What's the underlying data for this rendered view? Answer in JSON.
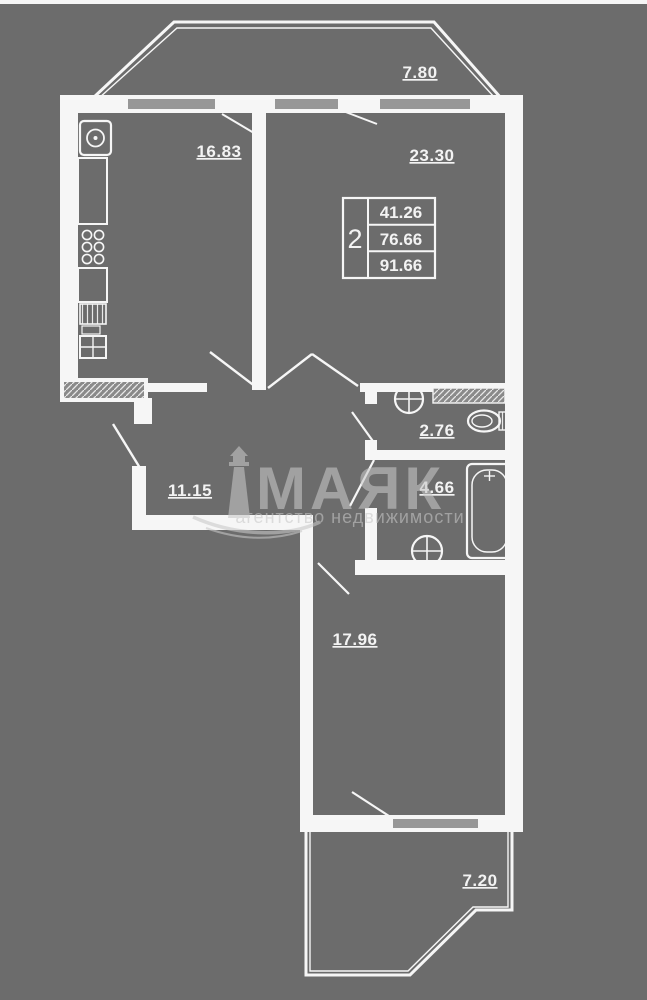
{
  "plan": {
    "stamp": {
      "rooms_count": "2",
      "living_area": "41.26",
      "area_without_balconies": "76.66",
      "total_area": "91.66"
    },
    "areas": {
      "balcony_top": "7.80",
      "kitchen": "16.83",
      "living_room": "23.30",
      "wc": "2.76",
      "bathroom": "4.66",
      "hallway": "11.15",
      "bedroom": "17.96",
      "balcony_bottom": "7.20"
    }
  },
  "watermark": {
    "brand": "МАЯК",
    "tagline": "агентство недвижимости"
  },
  "colors": {
    "background": "#6c6c6c",
    "line": "#f6f6f6",
    "window_fill": "#979797",
    "watermark": "#c8c8c8"
  }
}
